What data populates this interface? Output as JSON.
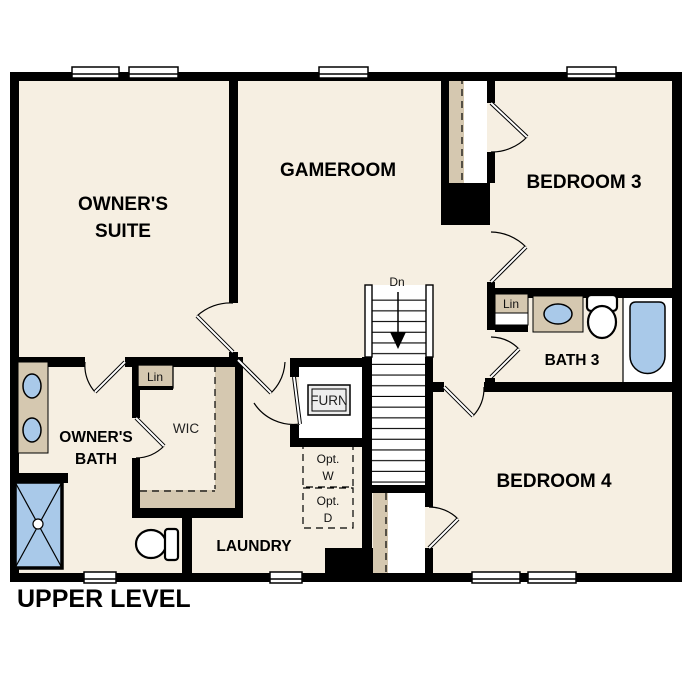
{
  "title": "UPPER LEVEL",
  "colors": {
    "floor": "#f6efe2",
    "closet_tan": "#d5c8b0",
    "fixture_blue": "#a9c9e9",
    "optional_gray": "#e4e4e4",
    "wall_black": "#000000",
    "background": "#ffffff"
  },
  "rooms": {
    "owners_suite": {
      "label_line1": "OWNER'S",
      "label_line2": "SUITE"
    },
    "gameroom": {
      "label": "GAMEROOM"
    },
    "bedroom3": {
      "label": "BEDROOM 3"
    },
    "bedroom4": {
      "label": "BEDROOM 4"
    },
    "bath3": {
      "label": "BATH 3"
    },
    "owners_bath": {
      "label_line1": "OWNER'S",
      "label_line2": "BATH"
    },
    "wic": {
      "label": "WIC"
    },
    "laundry": {
      "label": "LAUNDRY"
    }
  },
  "annotations": {
    "stairs_direction": "Dn",
    "furnace": "FURN",
    "linen_wic": "Lin",
    "linen_bath3": "Lin",
    "opt_washer_line1": "Opt.",
    "opt_washer_line2": "W",
    "opt_dryer_line1": "Opt.",
    "opt_dryer_line2": "D"
  }
}
